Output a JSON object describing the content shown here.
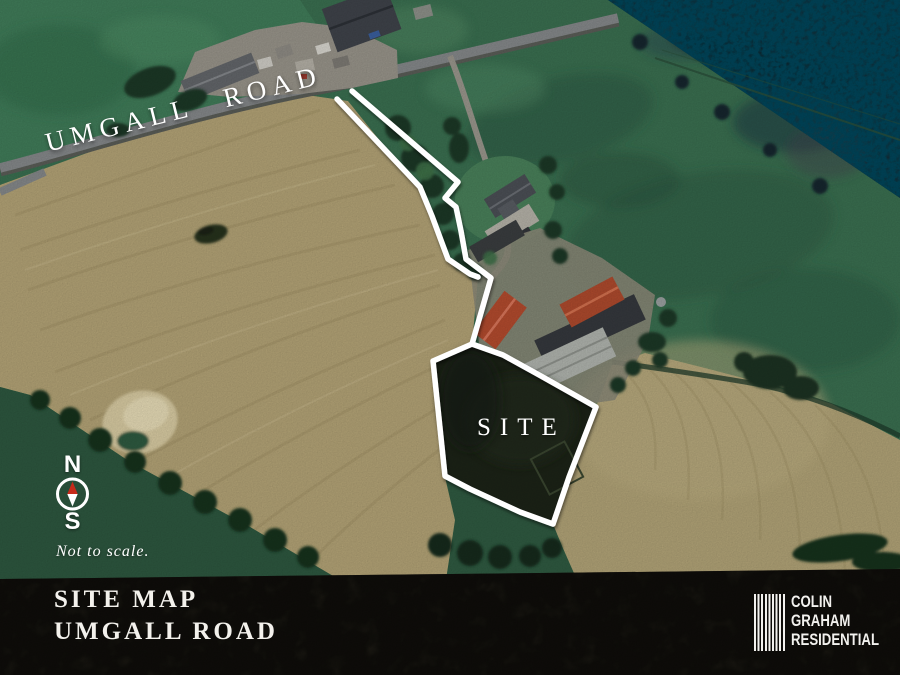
{
  "map": {
    "road_label": "UMGALL ROAD",
    "site_label": "SITE",
    "compass_north": "N",
    "compass_south": "S",
    "scale_note": "Not to scale."
  },
  "footer": {
    "title_line1": "SITE MAP",
    "title_line2": "UMGALL ROAD",
    "logo": {
      "line1": "COLIN",
      "line2": "GRAHAM",
      "line3": "RESIDENTIAL"
    }
  },
  "colors": {
    "annotation_white": "#ffffff",
    "compass_needle_red": "#c62a1a",
    "footer_background": "#242119",
    "tan_field": "#b3a376",
    "green_field": "#3a6f50",
    "forest": "#16262f",
    "site_interior": "#1c2317",
    "red_barn_roof": "#b04a2e"
  }
}
